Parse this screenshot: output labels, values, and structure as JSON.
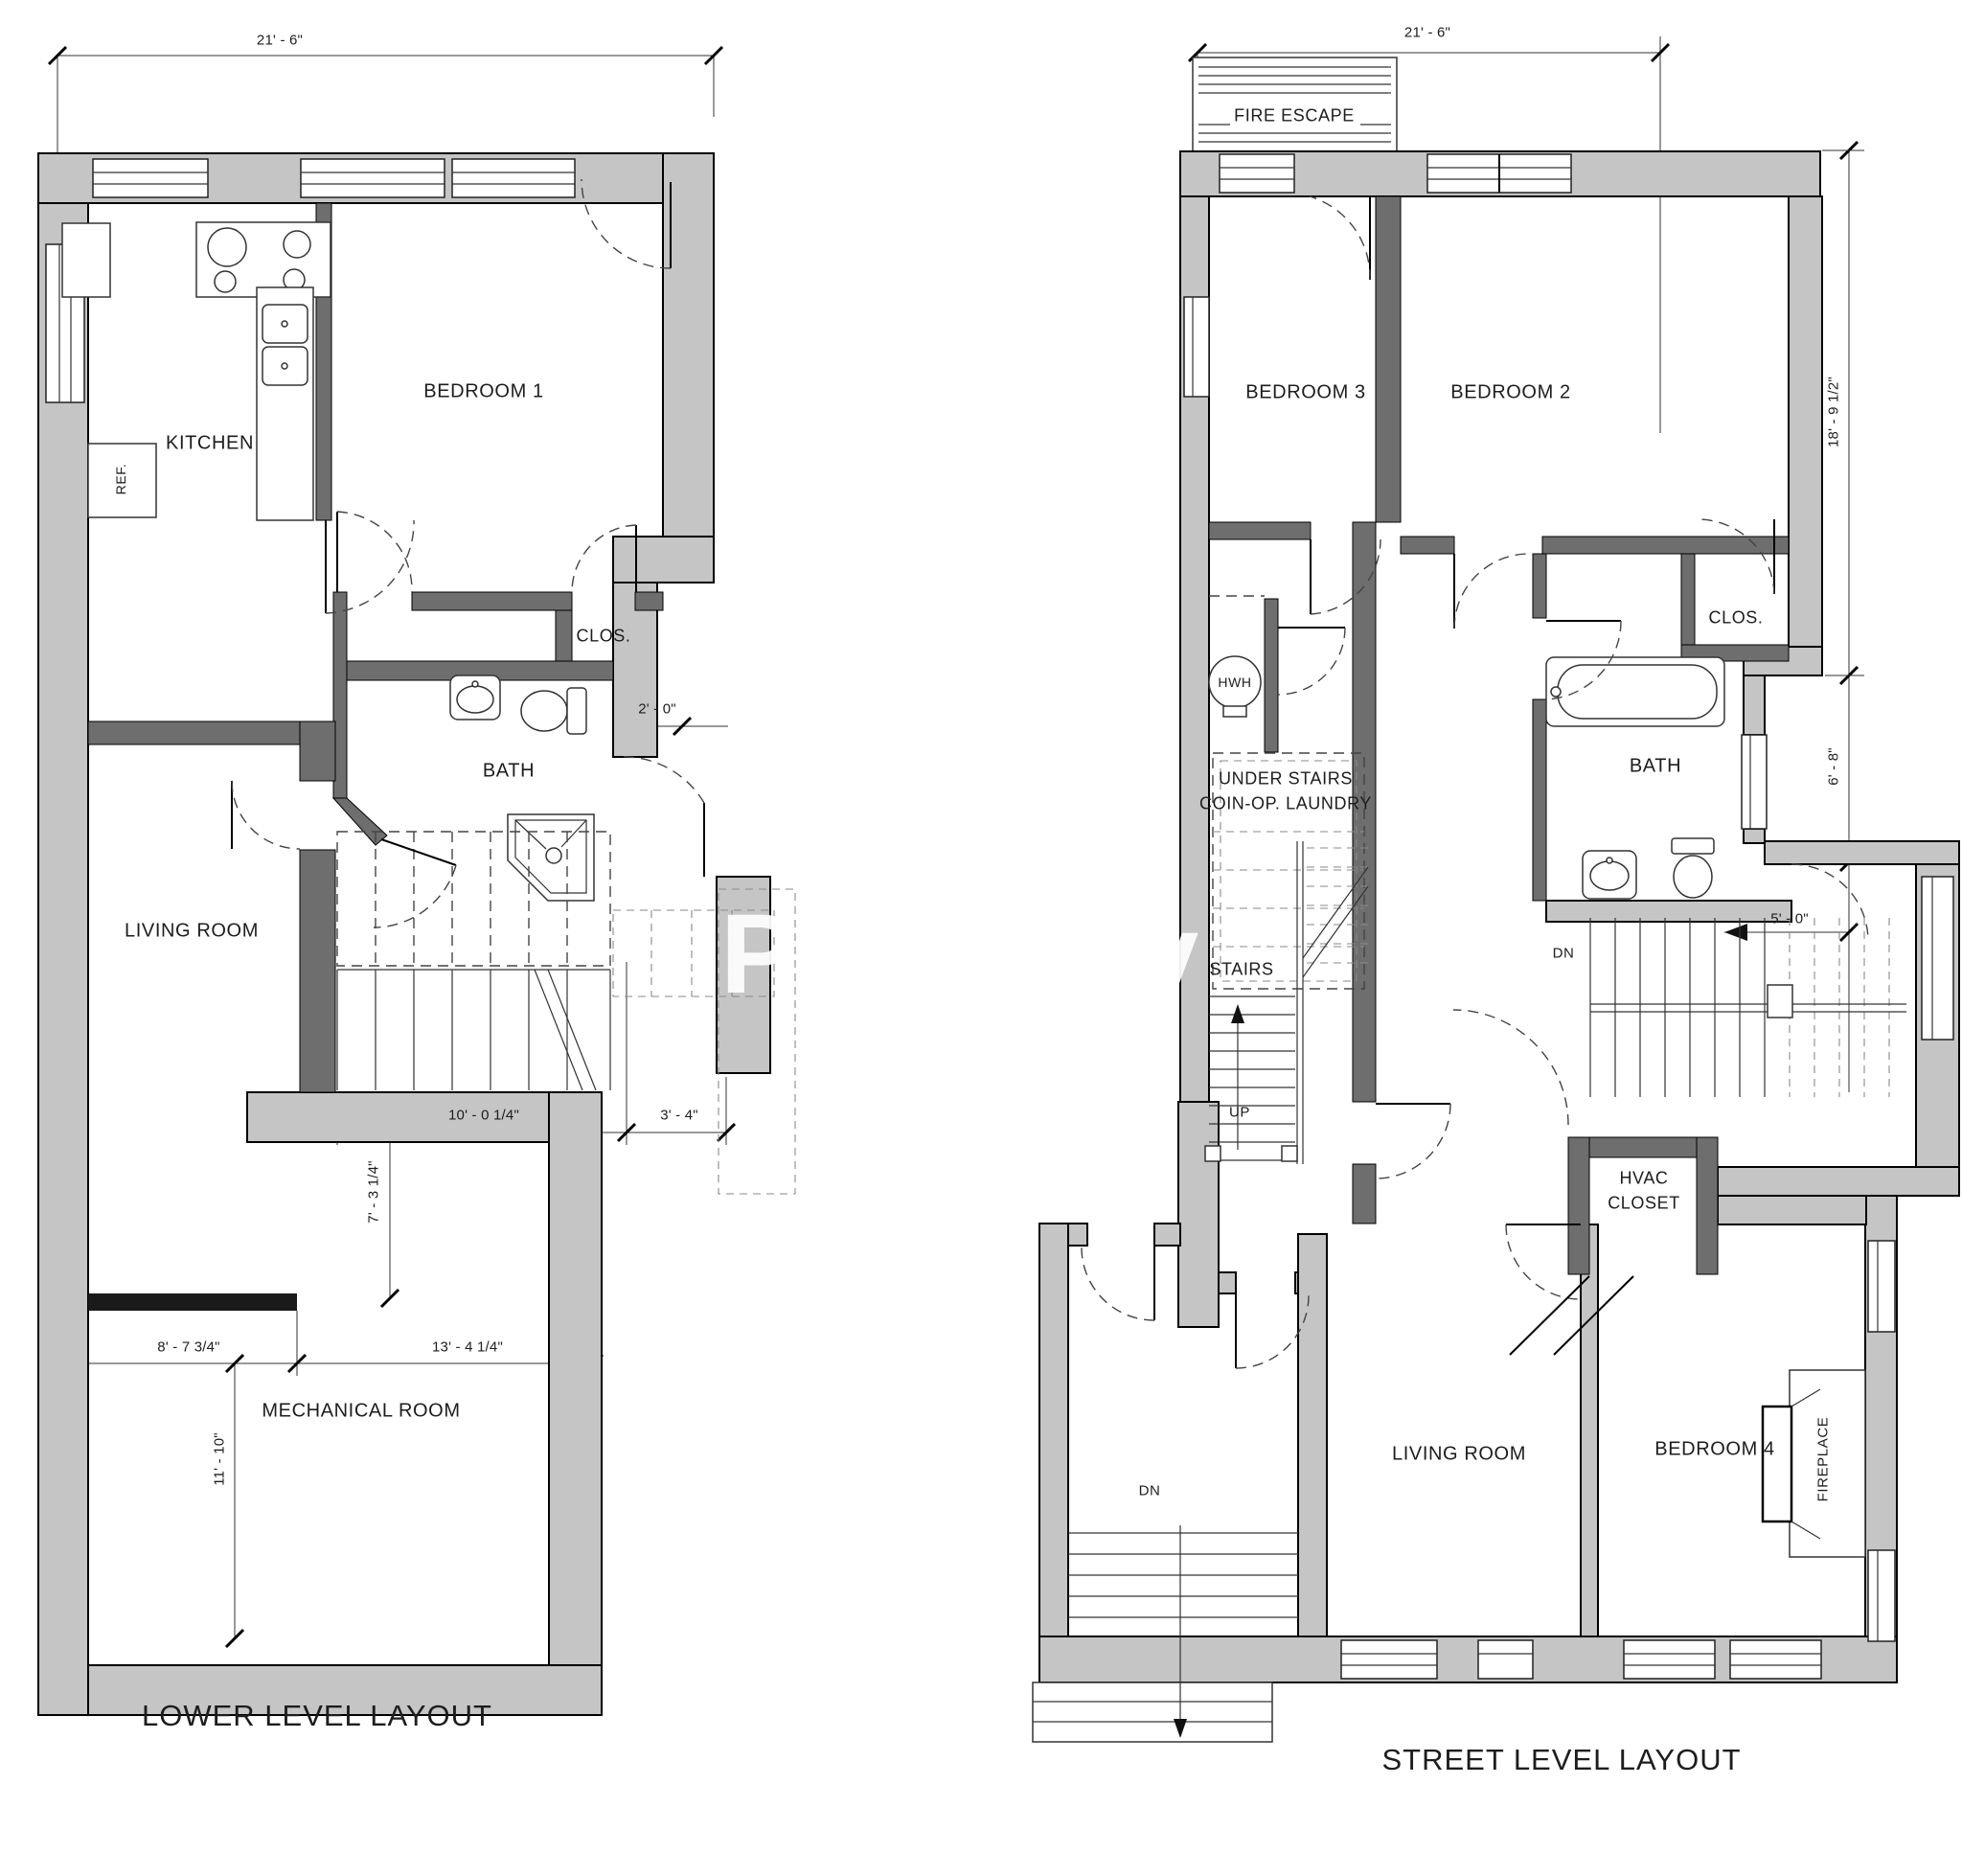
{
  "watermark": "Property",
  "lower_plan": {
    "title": "LOWER LEVEL LAYOUT",
    "labels": {
      "kitchen": "KITCHEN",
      "ref": "REF.",
      "bedroom1": "BEDROOM 1",
      "closet": "CLOS.",
      "bath": "BATH",
      "living_room": "LIVING ROOM",
      "mechanical_room": "MECHANICAL ROOM"
    },
    "dims": {
      "overall_width": "21' - 6\"",
      "bath_recess": "2' - 0\"",
      "stair_width": "10' - 0 1/4\"",
      "stair_offset": "3' - 4\"",
      "stair_depth": "7' - 3 1/4\"",
      "mech_left_width": "8' - 7 3/4\"",
      "mech_right_width": "13' - 4 1/4\"",
      "mech_depth": "11' - 10\""
    }
  },
  "street_plan": {
    "title": "STREET LEVEL LAYOUT",
    "labels": {
      "fire_escape": "FIRE ESCAPE",
      "bedroom3": "BEDROOM 3",
      "bedroom2": "BEDROOM 2",
      "closet": "CLOS.",
      "bath": "BATH",
      "hwh": "HWH",
      "laundry_line1": "UNDER STAIRS",
      "laundry_line2": "COIN-OP. LAUNDRY",
      "stairs": "STAIRS",
      "up": "UP",
      "dn_back": "DN",
      "hvac_line1": "HVAC",
      "hvac_line2": "CLOSET",
      "living_room": "LIVING ROOM",
      "bedroom4": "BEDROOM 4",
      "fireplace": "FIREPLACE",
      "dn_front": "DN"
    },
    "dims": {
      "overall_width": "21' - 6\"",
      "upper_depth": "18' - 9 1/2\"",
      "bath_depth": "6' - 8\"",
      "stair_run": "5' - 0\""
    }
  }
}
